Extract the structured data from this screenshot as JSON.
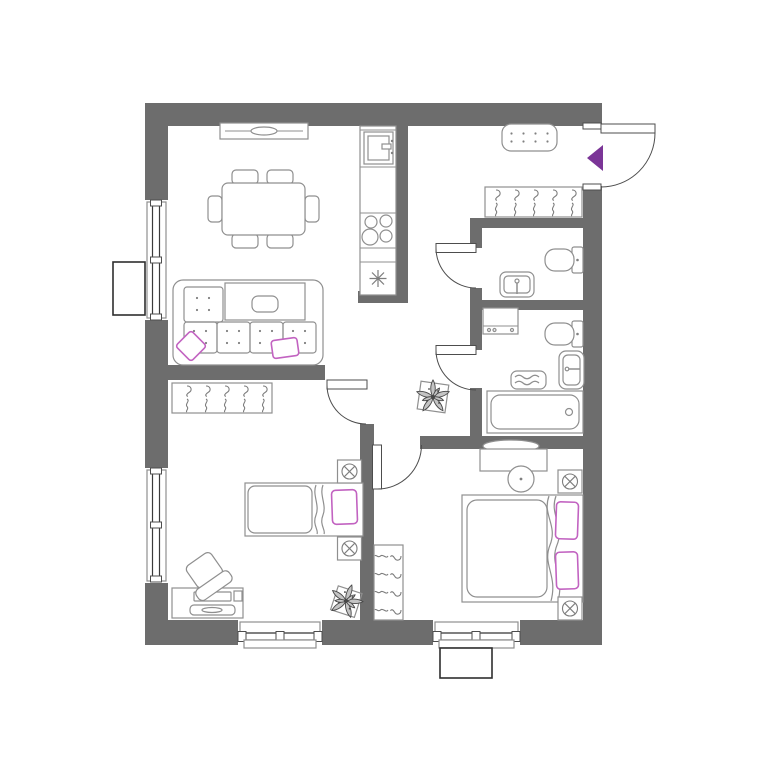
{
  "colors": {
    "wall": "#6d6d6d",
    "furniture_line": "#8f8f8f",
    "window_line": "#3a3a3a",
    "accent_purple": "#7b3597",
    "pillow_magenta": "#c263c1",
    "background": "#ffffff"
  },
  "plan": {
    "type": "apartment-floor-plan",
    "rooms": [
      {
        "name": "living-dining-kitchen",
        "furniture": [
          "wall-tv",
          "dining-table",
          "chairs-x6",
          "corner-sofa",
          "sofa-pillows-x2",
          "coffee-table",
          "kitchen-counter",
          "kitchen-sink",
          "stove-4-burners",
          "fridge"
        ]
      },
      {
        "name": "entrance-hall",
        "furniture": [
          "doormat",
          "coat-hook-rail-x5",
          "entrance-door",
          "entrance-arrow"
        ]
      },
      {
        "name": "wc",
        "furniture": [
          "toilet",
          "washbasin"
        ]
      },
      {
        "name": "bathroom",
        "furniture": [
          "washing-machine",
          "toilet",
          "washbasin",
          "towel-shelf",
          "bathtub"
        ]
      },
      {
        "name": "bedroom-small",
        "furniture": [
          "coat-hook-rail-x5",
          "single-bed",
          "pillow",
          "nightstand-lamp-x2",
          "desk",
          "desk-chair",
          "plant"
        ]
      },
      {
        "name": "bedroom-master",
        "furniture": [
          "dressing-table",
          "mirror",
          "stool",
          "double-bed",
          "pillows-x2",
          "nightstand-lamp-x2",
          "coat-hook-rail-x4"
        ]
      },
      {
        "name": "hallway",
        "furniture": [
          "plant"
        ]
      }
    ],
    "window_count": 4,
    "entrance_door_count": 1,
    "interior_door_count": 4,
    "exterior_unit_count": 2
  }
}
